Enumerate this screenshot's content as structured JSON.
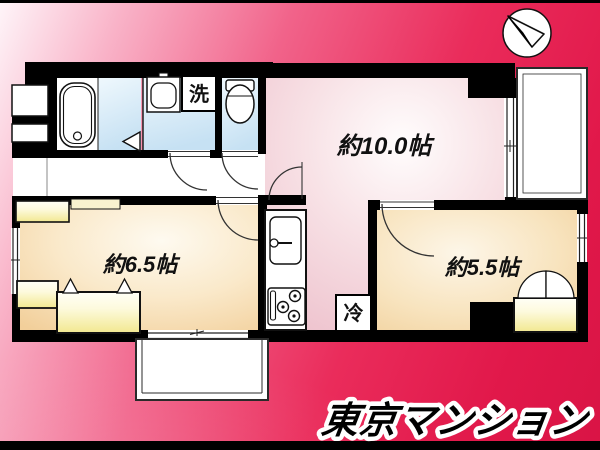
{
  "floor_plan": {
    "rooms": [
      {
        "name": "living-dining-kitchen",
        "size_label": "約10.0帖"
      },
      {
        "name": "western-room-1",
        "size_label": "約6.5帖"
      },
      {
        "name": "western-room-2",
        "size_label": "約5.5帖"
      }
    ],
    "labels": {
      "washing_machine": "洗",
      "refrigerator": "冷"
    },
    "icons": {
      "compass": "north-arrow-icon",
      "fixtures": [
        "bathtub-icon",
        "washbasin-icon",
        "toilet-icon",
        "kitchen-sink-icon",
        "stove-icon"
      ]
    }
  },
  "branding": {
    "logo": "東京マンション"
  },
  "colors": {
    "background_light": "#fef5f9",
    "background_deep": "#d91445",
    "wall": "#000000",
    "room_pink": "#efc6d0",
    "room_cream": "#f3d19c",
    "wet_area_blue": "#c6e1f3",
    "closet_yellow": "#f3ea96",
    "logo_fill": "#000000",
    "logo_outline": "#ffffff"
  }
}
